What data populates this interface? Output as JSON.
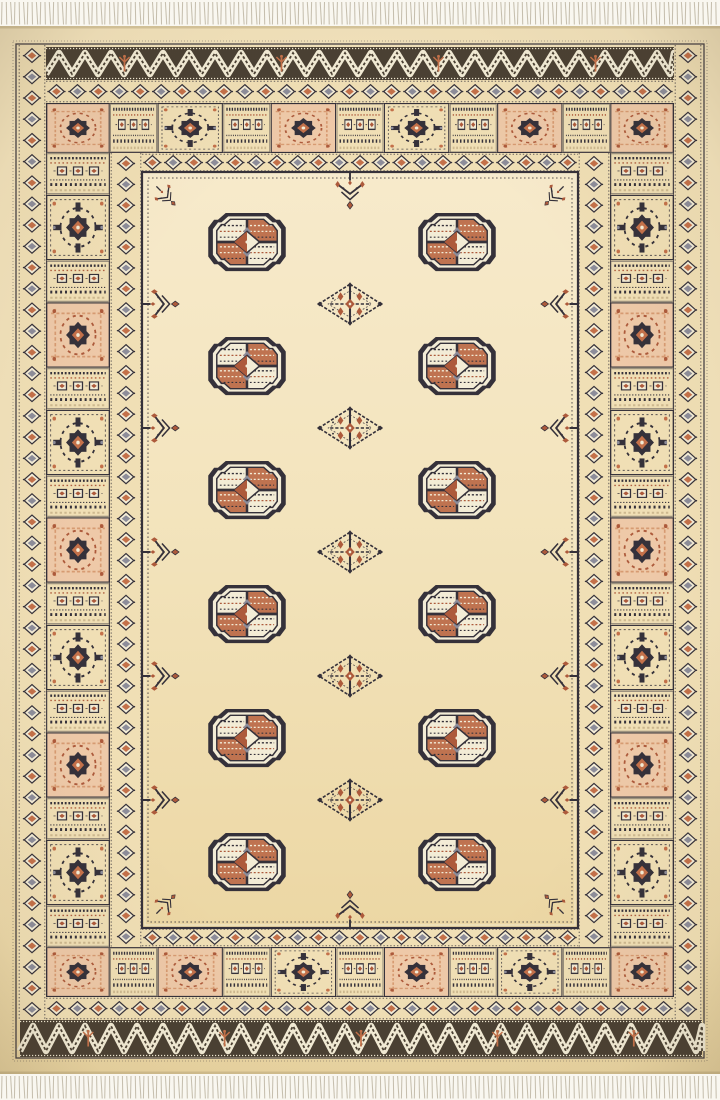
{
  "meta": {
    "subject": "Photograph of a hand-knotted beige Bokhara wool rug with two columns of six octagonal Tekke gul medallions, white fringe at top and bottom",
    "image_width": 720,
    "image_height": 1100
  },
  "palette": {
    "photo_bg": "#fbfaf5",
    "fringe_bg": "#f9f7f0",
    "fringe_line": "#c6bfae",
    "edge_shadow": "#b3a176",
    "cream": "#f2e2bb",
    "cream_dark": "#e9d4a1",
    "band_bg": "#f0dfb5",
    "field_top": "#f7eacb",
    "field_mid": "#f3e4bd",
    "field_bot": "#ecd7a4",
    "ivory": "#f3ecd6",
    "navy": "#35313a",
    "brown": "#4a4033",
    "rust": "#ad5a3b",
    "rust_bright": "#c4714a",
    "rust_quadrant": "#bf7350",
    "salmon_light": "#eec9a8",
    "salmon_dark": "#d79b72",
    "slate": "#8d8d9a",
    "tan": "#cdb88f"
  },
  "layout": {
    "canvas": {
      "w": 720,
      "h": 1100
    },
    "fringe_top": {
      "x": 0,
      "y": 0,
      "w": 720,
      "h": 26
    },
    "fringe_bottom": {
      "x": 0,
      "y": 1074,
      "w": 720,
      "h": 26
    },
    "rug": {
      "x": 0,
      "y": 26,
      "w": 720,
      "h": 1048
    },
    "outer_guard": {
      "x": 16,
      "y": 44,
      "w": 688,
      "h": 1014
    },
    "meander_bands": [
      {
        "x": 46,
        "y": 47,
        "w": 628,
        "h": 33,
        "trees": 4
      },
      {
        "x": 20,
        "y": 1020,
        "w": 682,
        "h": 37,
        "trees": 5
      }
    ],
    "diamond_bands": [
      {
        "x": 18,
        "y": 45,
        "w": 28,
        "h": 975,
        "dir": "v"
      },
      {
        "x": 674,
        "y": 45,
        "w": 28,
        "h": 975,
        "dir": "v"
      },
      {
        "x": 46,
        "y": 80,
        "w": 628,
        "h": 23,
        "dir": "h"
      },
      {
        "x": 46,
        "y": 997,
        "w": 628,
        "h": 23,
        "dir": "h"
      },
      {
        "x": 110,
        "y": 153,
        "w": 32,
        "h": 794,
        "dir": "v"
      },
      {
        "x": 578,
        "y": 153,
        "w": 32,
        "h": 794,
        "dir": "v"
      },
      {
        "x": 142,
        "y": 153,
        "w": 436,
        "h": 19,
        "dir": "h"
      },
      {
        "x": 142,
        "y": 928,
        "w": 436,
        "h": 19,
        "dir": "h"
      }
    ],
    "main_border": {
      "outer": {
        "x": 46,
        "y": 103,
        "w": 628,
        "h": 894
      },
      "inner": {
        "x": 110,
        "y": 153,
        "w": 500,
        "h": 794
      },
      "corners": [
        {
          "x": 46,
          "y": 103,
          "w": 64,
          "h": 50
        },
        {
          "x": 610,
          "y": 103,
          "w": 64,
          "h": 50
        },
        {
          "x": 46,
          "y": 947,
          "w": 64,
          "h": 50
        },
        {
          "x": 610,
          "y": 947,
          "w": 64,
          "h": 50
        }
      ],
      "runs": [
        {
          "x": 110,
          "y": 103,
          "len": 500,
          "th": 50,
          "dir": "h",
          "star_size": 66,
          "stars": [
            "navy",
            "salmon",
            "navy",
            "salmon"
          ]
        },
        {
          "x": 110,
          "y": 947,
          "len": 500,
          "th": 50,
          "dir": "h",
          "star_size": 66,
          "stars": [
            "salmon",
            "navy",
            "salmon",
            "navy"
          ]
        },
        {
          "x": 46,
          "y": 153,
          "len": 794,
          "th": 64,
          "dir": "v",
          "star_size": 66,
          "stars": [
            "navy",
            "salmon",
            "navy",
            "salmon",
            "navy",
            "salmon",
            "navy"
          ]
        },
        {
          "x": 610,
          "y": 153,
          "len": 794,
          "th": 64,
          "dir": "v",
          "star_size": 66,
          "stars": [
            "navy",
            "salmon",
            "navy",
            "salmon",
            "navy",
            "salmon",
            "navy"
          ]
        }
      ]
    },
    "field": {
      "x": 142,
      "y": 172,
      "w": 436,
      "h": 756
    },
    "guls": {
      "cols": [
        247,
        457
      ],
      "rows": [
        242,
        366,
        490,
        614,
        738,
        862
      ],
      "w": 82,
      "h": 62
    },
    "minor_guls": {
      "x": 350,
      "rows": [
        304,
        428,
        552,
        676,
        800
      ],
      "w": 68,
      "h": 46
    },
    "pendants": {
      "w": 42,
      "h": 38,
      "left": {
        "cx": 161,
        "rows": [
          304,
          428,
          552,
          676,
          800
        ],
        "rot": -90
      },
      "right": {
        "cx": 559,
        "rows": [
          304,
          428,
          552,
          676,
          800
        ],
        "rot": 90
      },
      "top": {
        "cy": 191,
        "cols": [
          350
        ],
        "rot": 0
      },
      "bottom": {
        "cy": 909,
        "cols": [
          350
        ],
        "rot": 180
      }
    },
    "corner_sprigs": [
      {
        "x": 166,
        "y": 196,
        "rot": -45
      },
      {
        "x": 554,
        "y": 196,
        "rot": 45
      },
      {
        "x": 166,
        "y": 904,
        "rot": -135
      },
      {
        "x": 554,
        "y": 904,
        "rot": 135
      }
    ]
  },
  "motif_counts": {
    "gul_medallions": 12,
    "minor_gul_motifs": 5,
    "edge_pendants": 12,
    "border_star_panels": 26,
    "border_corner_panels": 4
  }
}
